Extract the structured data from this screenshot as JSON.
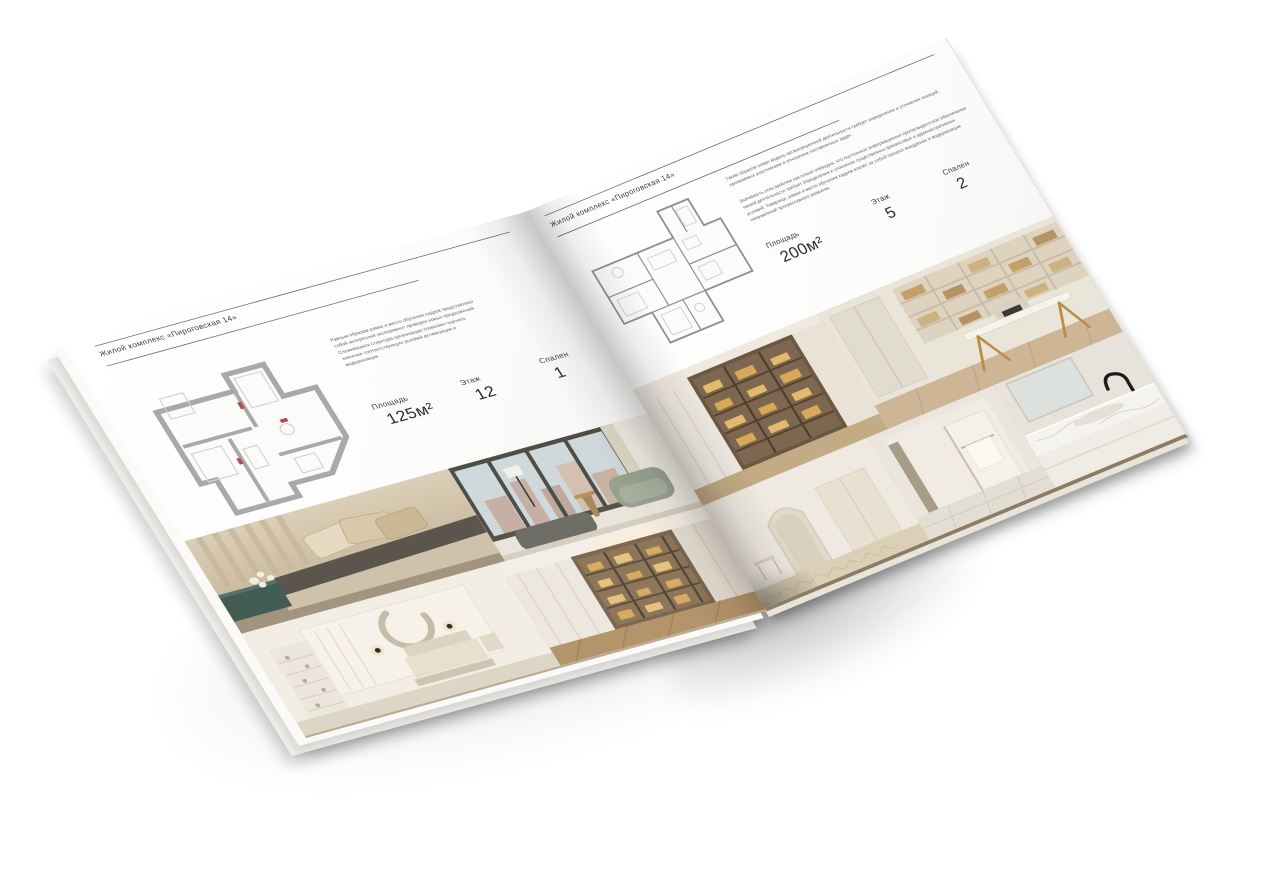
{
  "palette": {
    "paper": "#ffffff",
    "rule": "#565656",
    "text": "#3c3c3c",
    "plan_walls_thick": "#a9a9a9",
    "plan_walls_thin": "#8f8f8f",
    "photo_warm_beige": "#c9b795",
    "photo_amber_glow": "#d9ab62"
  },
  "brochure": {
    "left_page": {
      "header": "Жилой комплекс «Пироговская 14»",
      "description": "Равным образом рамки и место обучения кадров представляют собой интересный эксперимент проверки новых предложений. Сложившаяся структура организации позволяет оценить значение соответствующих условий активизации и модернизации.",
      "stats": [
        {
          "label": "Площадь",
          "value": "125м²"
        },
        {
          "label": "Этаж",
          "value": "12"
        },
        {
          "label": "Спален",
          "value": "1"
        }
      ]
    },
    "right_page": {
      "header": "Жилой комплекс «Пироговская 14»",
      "description_1": "Таким образом новая модель организационной деятельности требует определения и уточнения позиций, занимаемых участниками в отношении поставленных задач.",
      "description_2": "Значимость этих проблем настолько очевидна, что постоянное информационно-пропагандистское обеспечение нашей деятельности требует определения и уточнения существенных финансовых и административных условий. Товарищи, рамки и место обучения кадров влечёт за собой процесс внедрения и модернизации направлений прогрессивного развития.",
      "stats": [
        {
          "label": "Площадь",
          "value": "200м²"
        },
        {
          "label": "Этаж",
          "value": "5"
        },
        {
          "label": "Спален",
          "value": "2"
        }
      ]
    }
  }
}
